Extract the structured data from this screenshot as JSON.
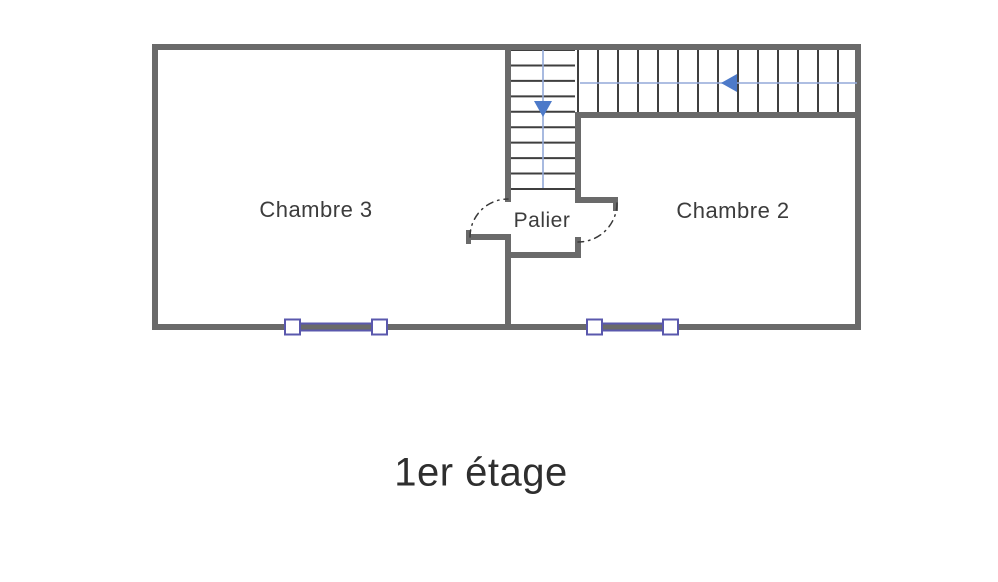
{
  "title": "1er étage",
  "rooms": {
    "chambre3": "Chambre 3",
    "chambre2": "Chambre 2",
    "palier": "Palier"
  },
  "colors": {
    "wall": "#6a6a6a",
    "tread": "#3f3f3f",
    "arrow_line": "#93a9d9",
    "arrow_head": "#4d7ac9",
    "window": "#5a58ad",
    "window_fill": "#ffffff",
    "door_arc": "#3a3a3a",
    "label_text": "#3c3c3c",
    "title_text": "#2e2e2e",
    "background": "#ffffff"
  },
  "floorplan": {
    "canvas": {
      "width": 998,
      "height": 582
    },
    "walls": [
      {
        "name": "wall-outer-top",
        "x": 152,
        "y": 44,
        "w": 709,
        "h": 6
      },
      {
        "name": "wall-outer-bottom",
        "x": 152,
        "y": 324,
        "w": 709,
        "h": 6
      },
      {
        "name": "wall-outer-left",
        "x": 152,
        "y": 44,
        "w": 6,
        "h": 286
      },
      {
        "name": "wall-outer-right",
        "x": 855,
        "y": 44,
        "w": 6,
        "h": 286
      },
      {
        "name": "wall-stairwell-left",
        "x": 505,
        "y": 44,
        "w": 6,
        "h": 158
      },
      {
        "name": "wall-stair-run-bottom",
        "x": 575,
        "y": 112,
        "w": 286,
        "h": 6
      },
      {
        "name": "wall-chambre2-left-upper",
        "x": 575,
        "y": 112,
        "w": 6,
        "h": 90
      },
      {
        "name": "wall-palier-right-stub",
        "x": 575,
        "y": 197,
        "w": 43,
        "h": 6
      },
      {
        "name": "wall-palier-right-jamb",
        "x": 613,
        "y": 197,
        "w": 5,
        "h": 14
      },
      {
        "name": "wall-palier-right-lower",
        "x": 575,
        "y": 237,
        "w": 6,
        "h": 21
      },
      {
        "name": "wall-palier-bottom",
        "x": 505,
        "y": 252,
        "w": 76,
        "h": 6
      },
      {
        "name": "wall-room-divider",
        "x": 505,
        "y": 234,
        "w": 6,
        "h": 96
      },
      {
        "name": "wall-palier-left-stub",
        "x": 468,
        "y": 234,
        "w": 40,
        "h": 6
      },
      {
        "name": "wall-palier-left-jamb",
        "x": 466,
        "y": 230,
        "w": 5,
        "h": 14
      }
    ],
    "stair_runs": [
      {
        "name": "stair-run-down",
        "orientation": "vertical",
        "x1": 511,
        "x2": 575,
        "start": 50,
        "end": 189,
        "treads": 10
      },
      {
        "name": "stair-run-upper",
        "orientation": "horizontal",
        "y1": 50,
        "y2": 112,
        "start": 578,
        "end": 858,
        "treads": 15
      }
    ],
    "direction_arrows": [
      {
        "name": "stair-arrow-down",
        "dir": "down",
        "x": 543,
        "y1": 50,
        "y2": 188,
        "tip_x": 543,
        "tip_y": 117,
        "head_w": 18,
        "head_l": 16
      },
      {
        "name": "stair-arrow-left",
        "dir": "left",
        "y": 83,
        "x1": 580,
        "x2": 857,
        "tip_x": 721,
        "tip_y": 83,
        "head_w": 18,
        "head_l": 16
      }
    ],
    "windows": [
      {
        "name": "window-chambre3",
        "x1": 285,
        "x2": 387,
        "cy": 327,
        "box": 15
      },
      {
        "name": "window-chambre2",
        "x1": 587,
        "x2": 678,
        "cy": 327,
        "box": 15
      }
    ],
    "door_arcs": [
      {
        "name": "door-arc-chambre3",
        "path": "M 470 237 A 38 38 0 0 1 508 199"
      },
      {
        "name": "door-arc-chambre2",
        "path": "M 617 203 A 39 39 0 0 1 578 242"
      }
    ]
  }
}
